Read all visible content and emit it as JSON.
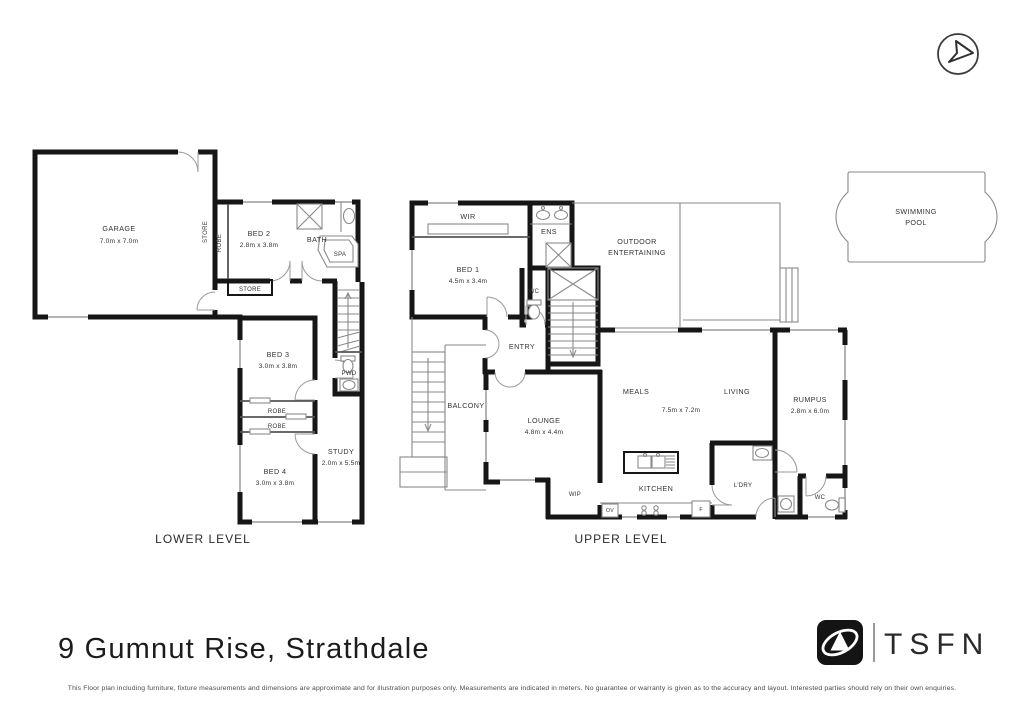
{
  "page": {
    "address": "9 Gumnut Rise, Strathdale",
    "brand": "TSFN",
    "disclaimer": "This Floor plan including furniture, fixture measurements and dimensions are approximate and for illustration purposes only. Measurements are indicated in meters. No guarantee or warranty is given as to the accuracy and layout. Interested parties should rely on their own enquiries.",
    "colors": {
      "wall": "#161616",
      "logo": "#141414",
      "label": "#333333"
    }
  },
  "icons": {
    "compass": "north-arrow",
    "logo_mark": "swoosh-triangle"
  },
  "lower_level": {
    "label": "LOWER LEVEL",
    "garage": {
      "name": "GARAGE",
      "dims": "7.0m x 7.0m"
    },
    "store_vertical": "STORE",
    "store_hall": "STORE",
    "robe_bed2": "ROBE",
    "bed2": {
      "name": "BED 2",
      "dims": "2.8m x 3.8m"
    },
    "bath": "BATH",
    "spa": "SPA",
    "pwd": "PWD",
    "bed3": {
      "name": "BED 3",
      "dims": "3.0m x 3.8m"
    },
    "robe_bed3": "ROBE",
    "robe_bed4": "ROBE",
    "bed4": {
      "name": "BED 4",
      "dims": "3.0m x 3.8m"
    },
    "study": {
      "name": "STUDY",
      "dims": "2.0m x 5.5m"
    }
  },
  "upper_level": {
    "label": "UPPER LEVEL",
    "wir": "WIR",
    "bed1": {
      "name": "BED 1",
      "dims": "4.5m x 3.4m"
    },
    "ens": "ENS",
    "wc_front": "WC",
    "entry": "ENTRY",
    "outdoor": {
      "line1": "OUTDOOR",
      "line2": "ENTERTAINING"
    },
    "balcony": "BALCONY",
    "lounge": {
      "name": "LOUNGE",
      "dims": "4.8m x 4.4m"
    },
    "meals": "MEALS",
    "living": "LIVING",
    "meals_living_dims": "7.5m x 7.2m",
    "kitchen": "KITCHEN",
    "wip": "WIP",
    "oven": "OV",
    "fridge": "F",
    "laundry": "L'DRY",
    "wc_rear": "WC",
    "rumpus": {
      "name": "RUMPUS",
      "dims": "2.8m x 6.0m"
    }
  },
  "pool": {
    "line1": "SWIMMING",
    "line2": "POOL"
  }
}
